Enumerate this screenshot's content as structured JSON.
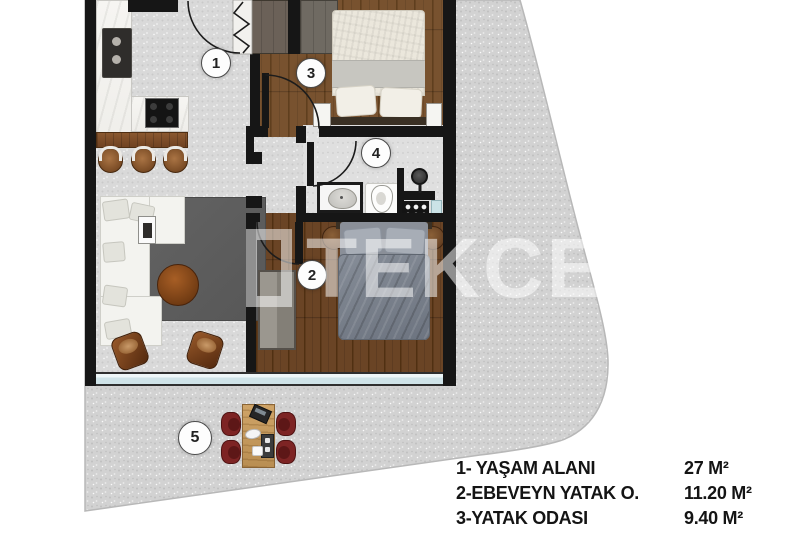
{
  "watermark": {
    "text": "TEKCE"
  },
  "room_markers": {
    "living": "1",
    "master_bedroom": "2",
    "bedroom": "3",
    "bathroom": "4",
    "terrace": "5"
  },
  "legend": {
    "items": [
      {
        "label": "1- YAŞAM ALANI",
        "value": "27 M²"
      },
      {
        "label": "2-EBEVEYN YATAK O.",
        "value": "11.20 M²"
      },
      {
        "label": "3-YATAK ODASI",
        "value": "9.40 M²"
      }
    ]
  },
  "colors": {
    "wall": "#161616",
    "terrace_floor": "#d2d2d2",
    "interior_gray_floor": "#d9d9d9",
    "wood_floor_bedroom3": "#78522f",
    "wood_floor_master": "#6a4425",
    "glass_wall": "#cfe3e8",
    "dining_chair_red": "#7d2424",
    "rug_gray": "#5f5f5f"
  }
}
